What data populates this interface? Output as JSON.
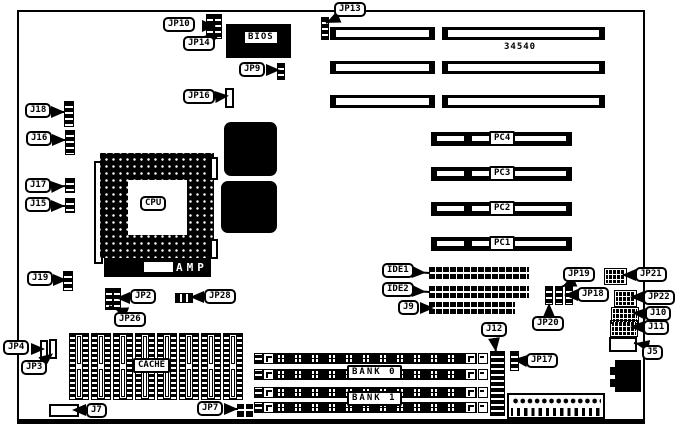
{
  "board": {
    "part_number": "34540",
    "chips": {
      "bios": "BIOS",
      "cpu": "CPU",
      "cpu_socket_brand": "AMP",
      "cache": "CACHE"
    },
    "slots": {
      "pc1": "PC1",
      "pc2": "PC2",
      "pc3": "PC3",
      "pc4": "PC4"
    },
    "memory": {
      "bank0": "BANK 0",
      "bank1": "BANK 1"
    },
    "connectors": {
      "ide1": "IDE1",
      "ide2": "IDE2",
      "j5": "J5",
      "j7": "J7",
      "j9": "J9",
      "j10": "J10",
      "j11": "J11",
      "j12": "J12",
      "j15": "J15",
      "j16": "J16",
      "j17": "J17",
      "j18": "J18",
      "j19": "J19"
    },
    "jumpers": {
      "jp2": "JP2",
      "jp3": "JP3",
      "jp4": "JP4",
      "jp7": "JP7",
      "jp9": "JP9",
      "jp10": "JP10",
      "jp13": "JP13",
      "jp14": "JP14",
      "jp16": "JP16",
      "jp17": "JP17",
      "jp18": "JP18",
      "jp19": "JP19",
      "jp20": "JP20",
      "jp21": "JP21",
      "jp22": "JP22",
      "jp26": "JP26",
      "jp28": "JP28"
    }
  }
}
